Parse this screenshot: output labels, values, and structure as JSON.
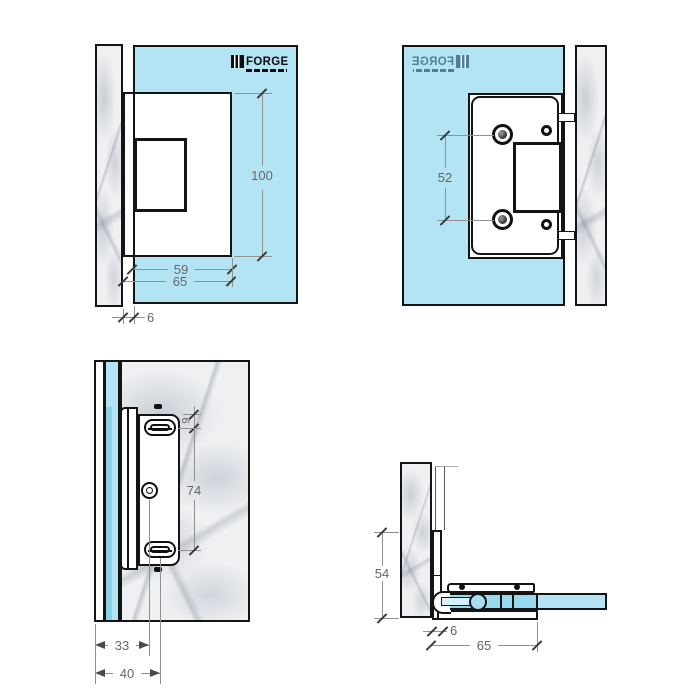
{
  "brand": {
    "name": "FORGE"
  },
  "views": {
    "front_view": {
      "label_height": "100",
      "label_width_inner": "59",
      "label_width_overall": "65",
      "label_gap": "6"
    },
    "back_view": {
      "label_hole_spacing": "52"
    },
    "side_view": {
      "label_top_offset": "9",
      "label_hole_spacing": "74",
      "label_depth_circle": "33",
      "label_depth_slot": "40"
    },
    "section_view": {
      "label_plate_height": "54",
      "label_plate_thickness": "6",
      "label_overall_depth": "65"
    }
  },
  "colors": {
    "glass": "#b2e4f3",
    "marble_base": "#eef0f2",
    "outline": "#141414",
    "dimension_text": "#666666"
  }
}
